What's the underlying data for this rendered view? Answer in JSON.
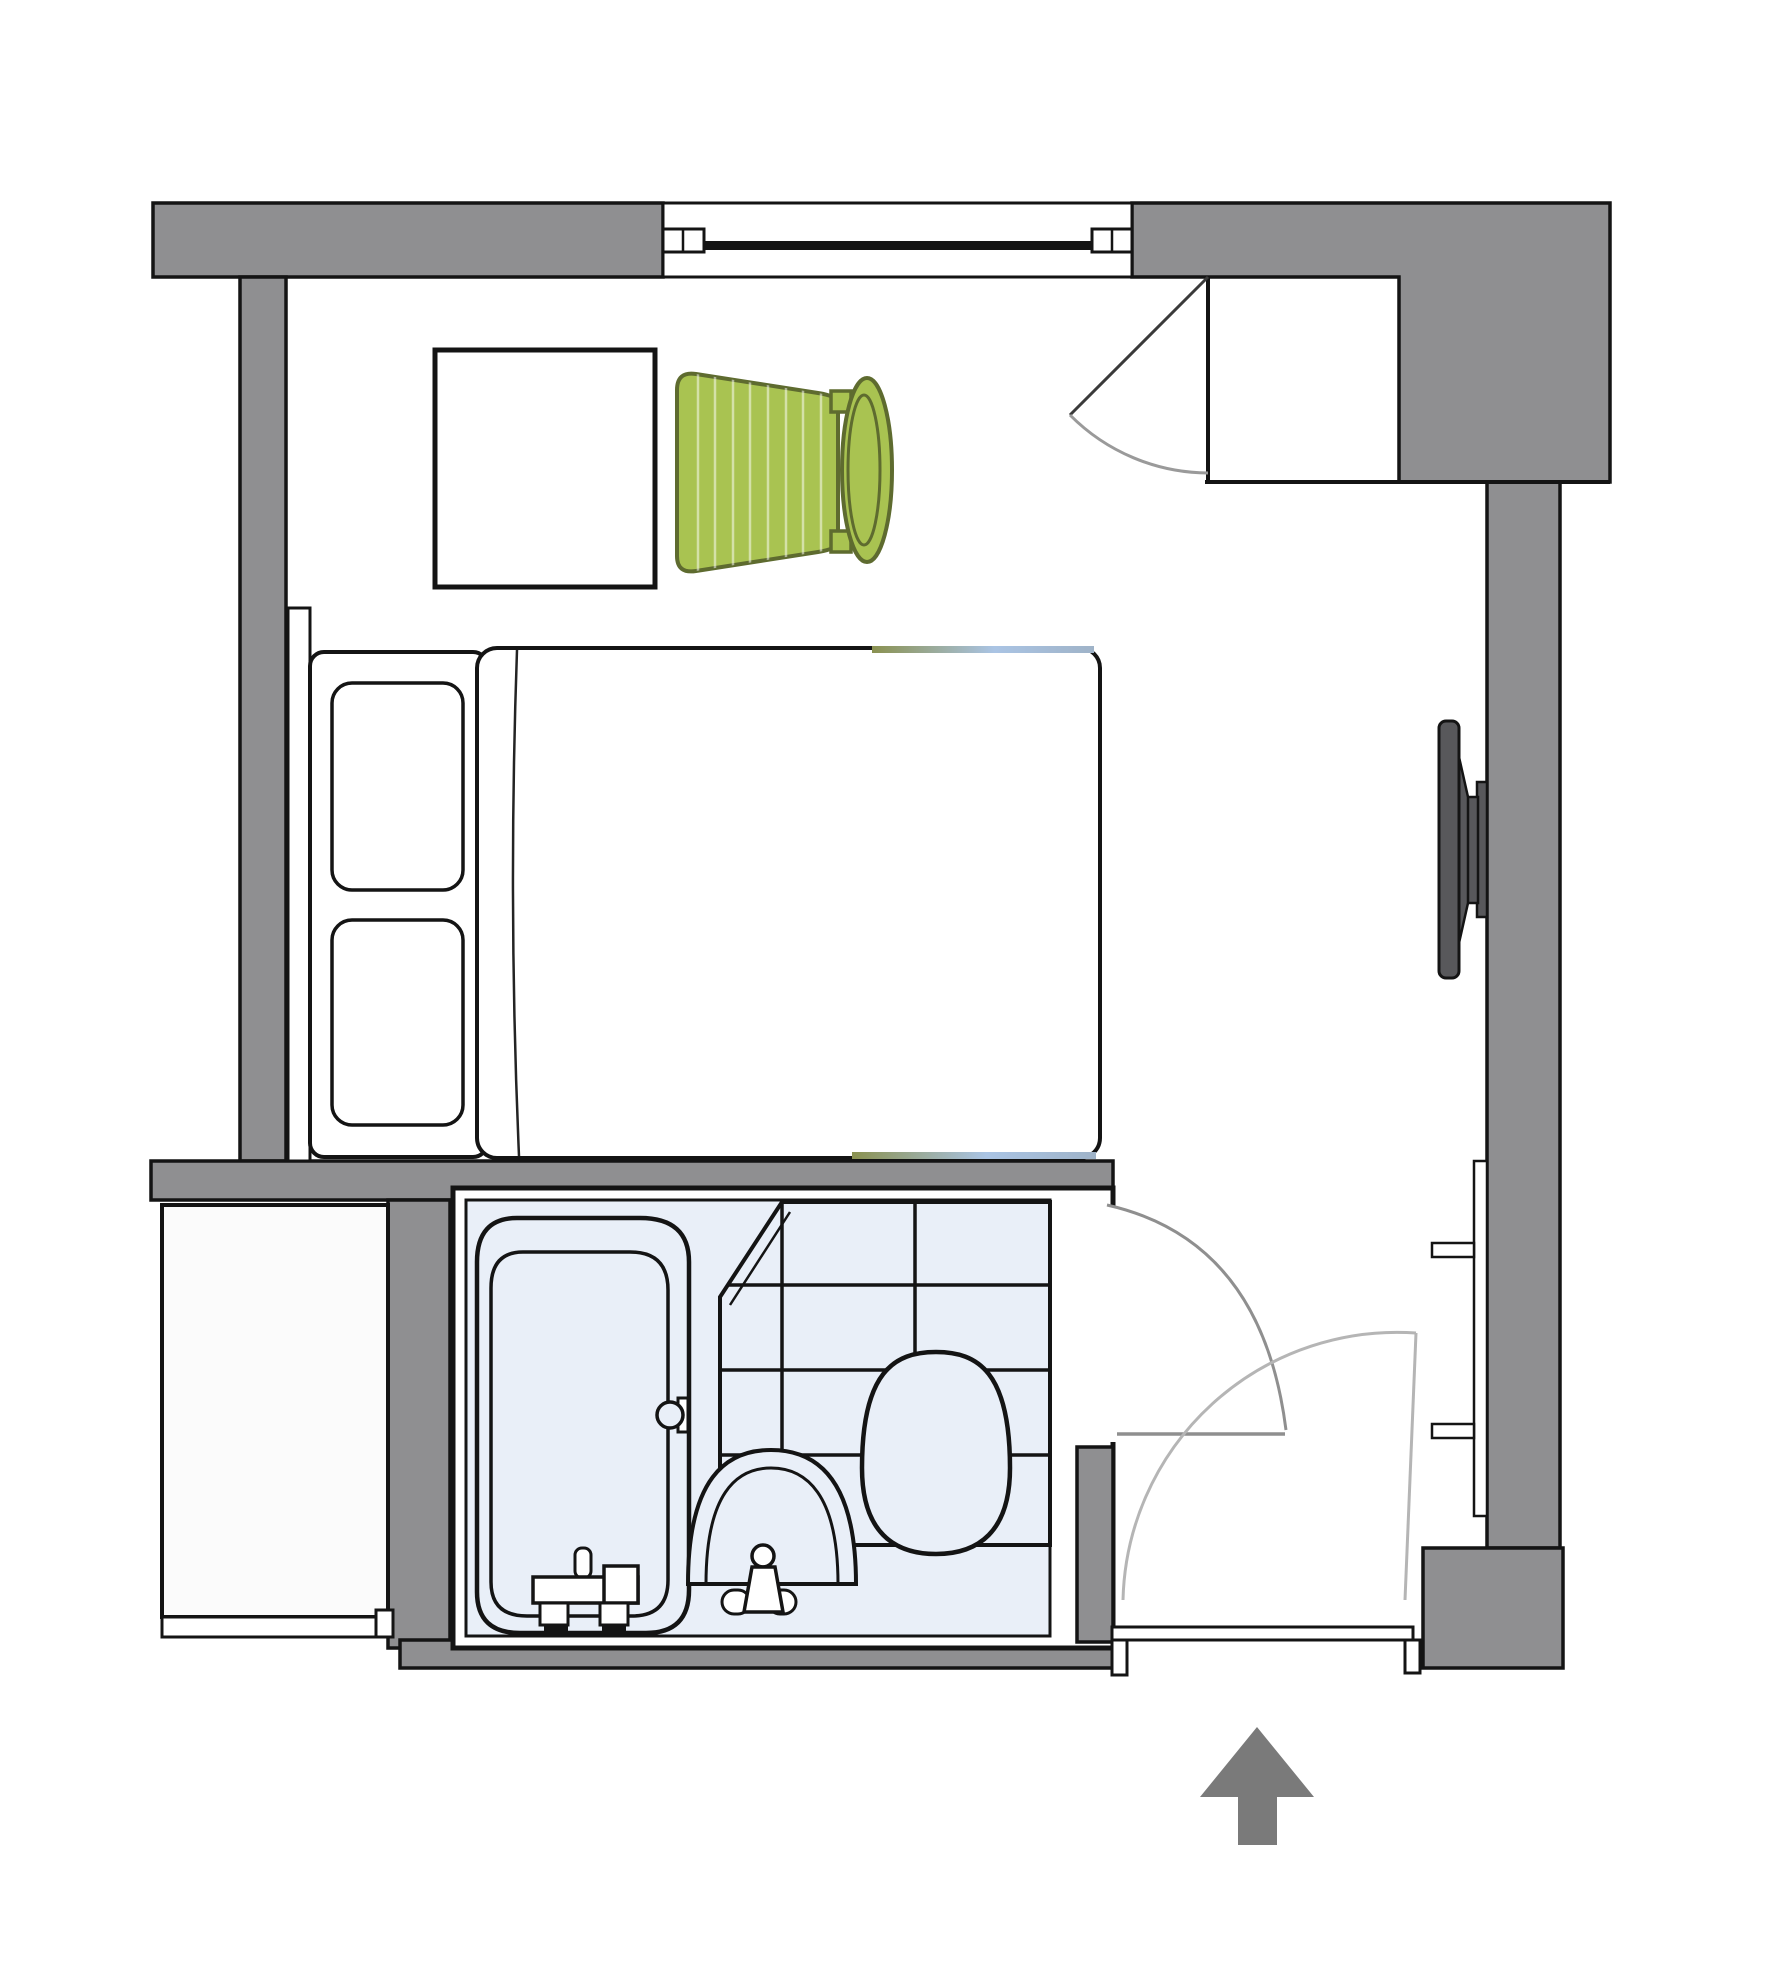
{
  "meta": {
    "title": "Hotel room floor plan",
    "type": "architectural-floor-plan",
    "visible_text": "none"
  },
  "colors": {
    "wall": "#8f8f91",
    "outline": "#141414",
    "floorWhite": "#ffffff",
    "bathFloor": "#e9eff8",
    "adjacentRoom": "#fbfbfb",
    "chairFill": "#a9c351",
    "chairOutline": "#5e6b2f",
    "chairStripe": "rgba(255,255,255,0.5)",
    "tv": "#58585b",
    "arrow": "#7a7a7a",
    "arcLight": "#b5b5b5",
    "arcMed": "#8f8f8f",
    "doorLeafDark": "#3a3a3a",
    "runnerOlive": "#8a9150",
    "runnerBlue": "#aac4e4"
  },
  "elements": [
    {
      "name": "window",
      "kind": "window",
      "location": "top-wall"
    },
    {
      "name": "closet-niche",
      "kind": "closet",
      "location": "top-right",
      "door": "swing-open-left"
    },
    {
      "name": "desk",
      "kind": "table",
      "location": "top-left"
    },
    {
      "name": "chair",
      "kind": "chair",
      "location": "beside-desk",
      "color": "green"
    },
    {
      "name": "bed",
      "kind": "double-bed",
      "pillows": 2,
      "location": "left"
    },
    {
      "name": "tv",
      "kind": "wall-mounted-tv",
      "location": "right-wall"
    },
    {
      "name": "wall-shelf",
      "kind": "shelf",
      "brackets": 2,
      "location": "right-wall"
    },
    {
      "name": "bathroom",
      "kind": "unit-bathroom",
      "fixtures": [
        "bathtub",
        "sink",
        "toilet",
        "tiled-area"
      ]
    },
    {
      "name": "bathroom-door",
      "kind": "door",
      "swing": "into-hallway"
    },
    {
      "name": "entrance-door",
      "kind": "door",
      "swing": "inward"
    },
    {
      "name": "adjacent-room",
      "kind": "adjacent-space",
      "location": "bottom-left"
    },
    {
      "name": "entry-arrow",
      "kind": "direction-arrow",
      "direction": "up",
      "location": "below-entrance"
    }
  ],
  "tile_grid": {
    "columns": 3,
    "rows": 4,
    "corner": "chamfered-top-left"
  }
}
